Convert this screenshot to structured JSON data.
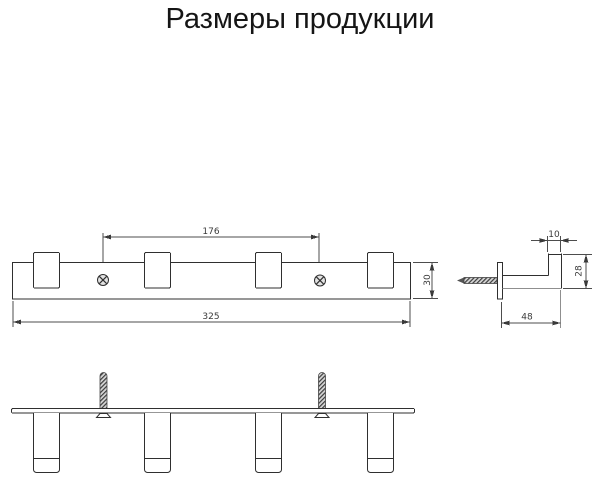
{
  "page": {
    "title": "Размеры продукции"
  },
  "colors": {
    "line": "#2f2f2f",
    "dim_line": "#4d4d4d",
    "thin_line": "#8f8f8f",
    "background": "#ffffff"
  },
  "front_view": {
    "dims": {
      "screw_spacing": "176",
      "total_length": "325",
      "rail_height": "30"
    }
  },
  "side_view": {
    "dims": {
      "hook_thickness": "10",
      "hook_rise": "28",
      "depth": "48"
    }
  }
}
